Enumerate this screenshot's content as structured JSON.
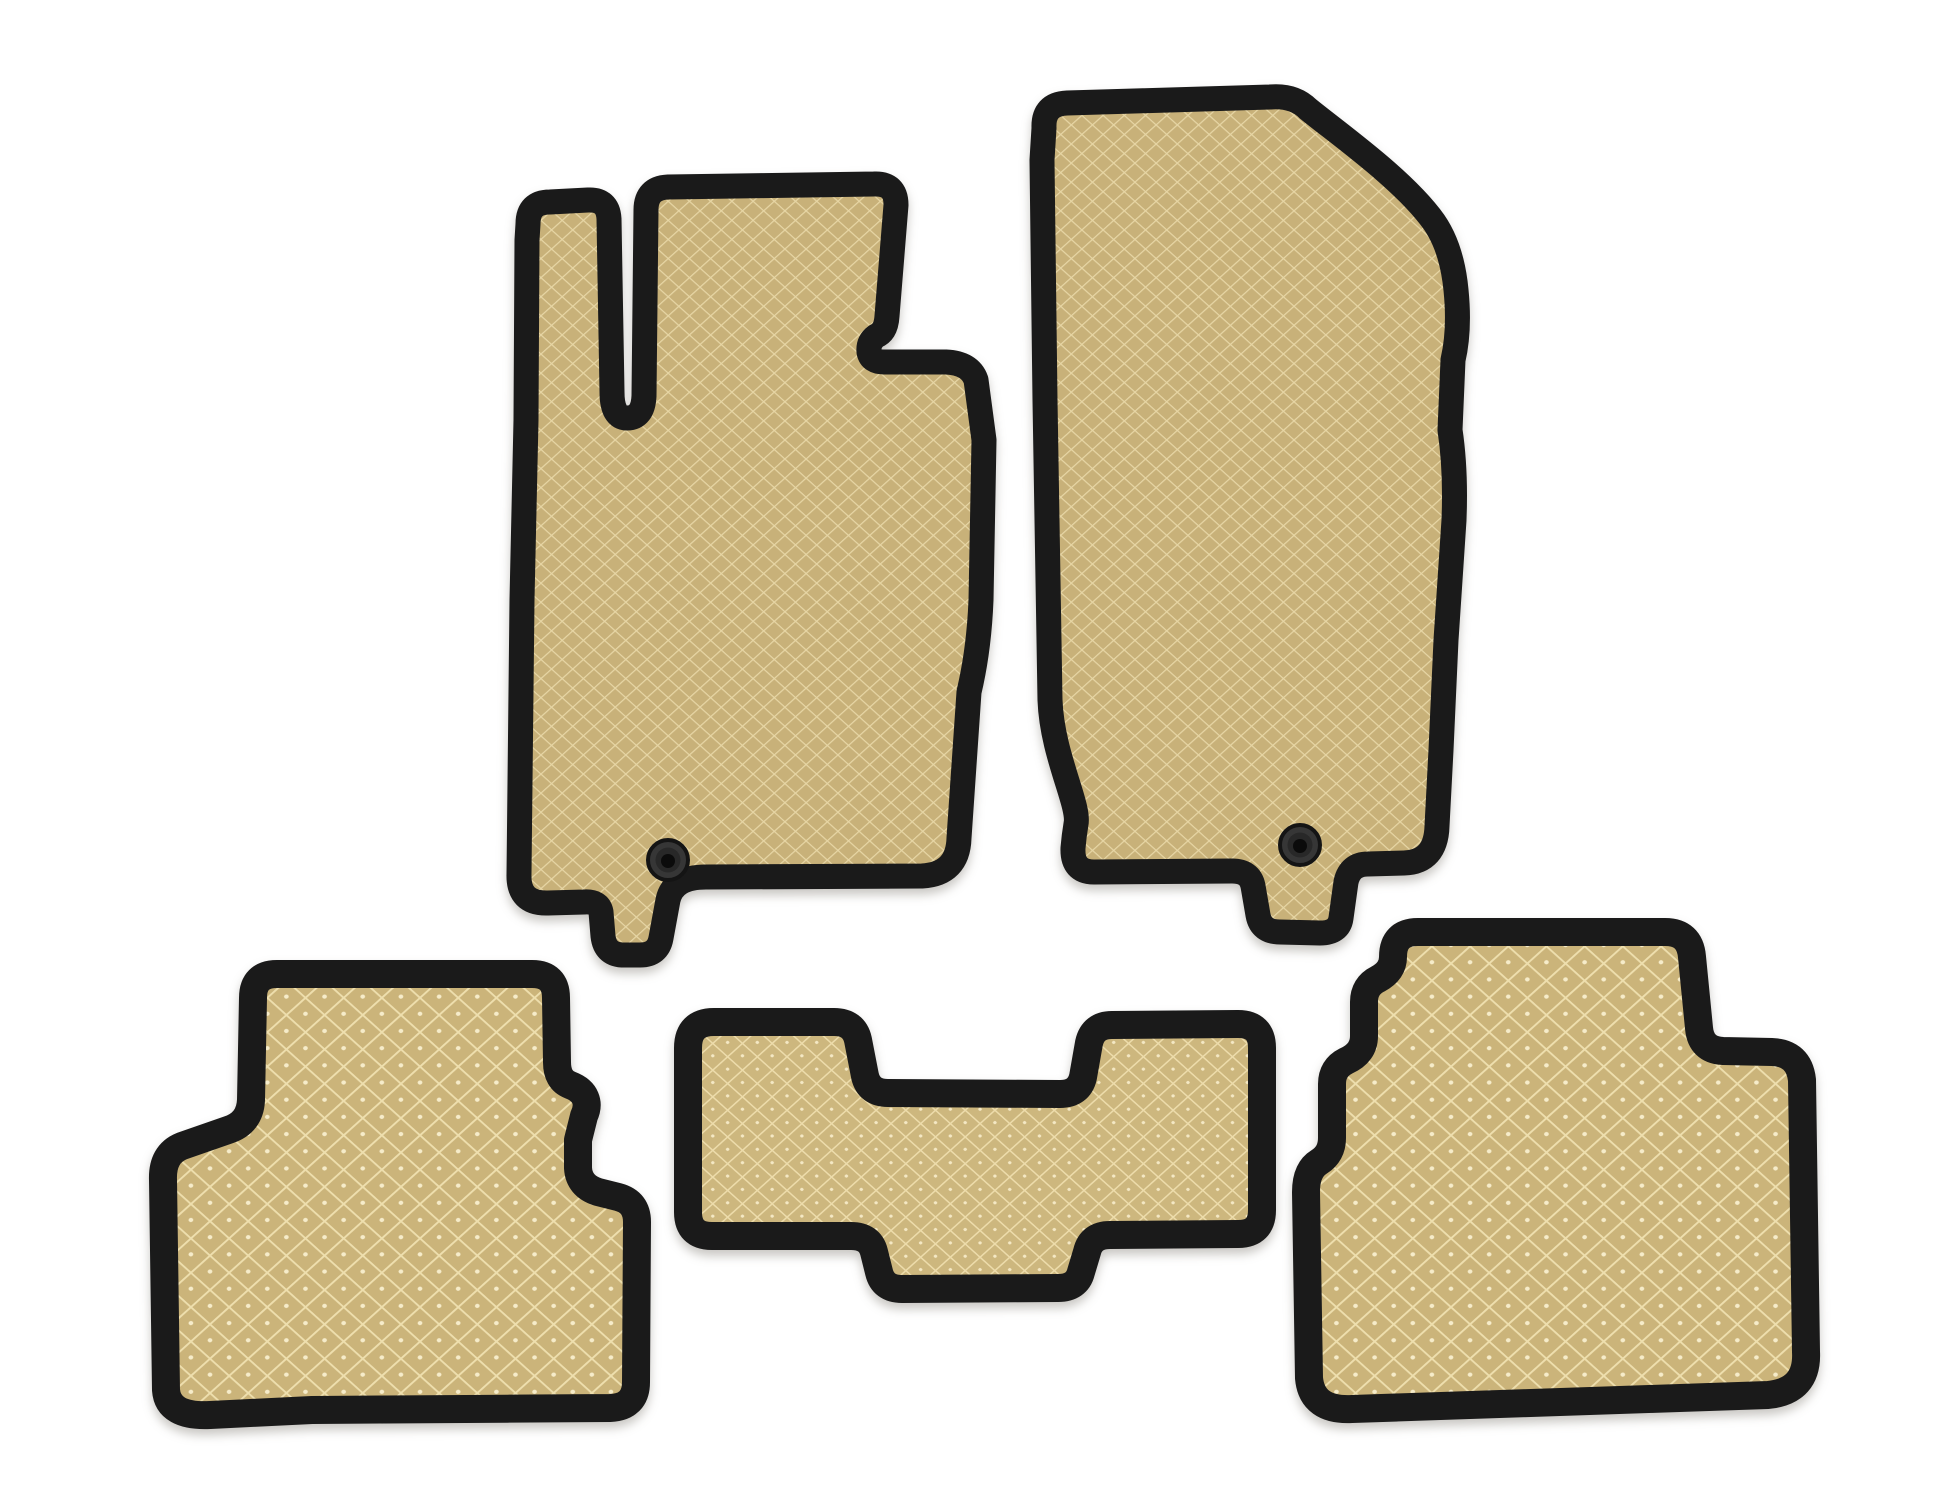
{
  "page": {
    "title": "Set of five beige EVA car floor mats with black trim on white background",
    "background_color": "#ffffff",
    "item_count": "5"
  },
  "colors": {
    "page_bg": "#ffffff",
    "mat_edge": "#1a1a1a",
    "front_base": "#c8b179",
    "front_line": "#e7d6a5",
    "mid_base": "#cdb77e",
    "mid_line": "#eddcab",
    "mid_dot": "#f4e8c4",
    "rear_base": "#cbb47a",
    "rear_line": "#eedfae",
    "rear_dot": "#f6ecca",
    "grommet_body": "#363636",
    "grommet_ring": "#282828",
    "grommet_hole": "#0b0b0b",
    "grommet_rim": "#141414"
  },
  "mats": {
    "front_left": {
      "label": "front-left-mat",
      "texture": "fine-diamond",
      "grommets": 1
    },
    "front_right": {
      "label": "front-right-mat",
      "texture": "fine-diamond",
      "grommets": 1
    },
    "rear_left": {
      "label": "rear-left-mat",
      "texture": "coarse-diamond",
      "grommets": 0
    },
    "tunnel": {
      "label": "center-tunnel-mat",
      "texture": "medium-diamond",
      "grommets": 0
    },
    "rear_right": {
      "label": "rear-right-mat",
      "texture": "coarse-diamond",
      "grommets": 0
    }
  }
}
